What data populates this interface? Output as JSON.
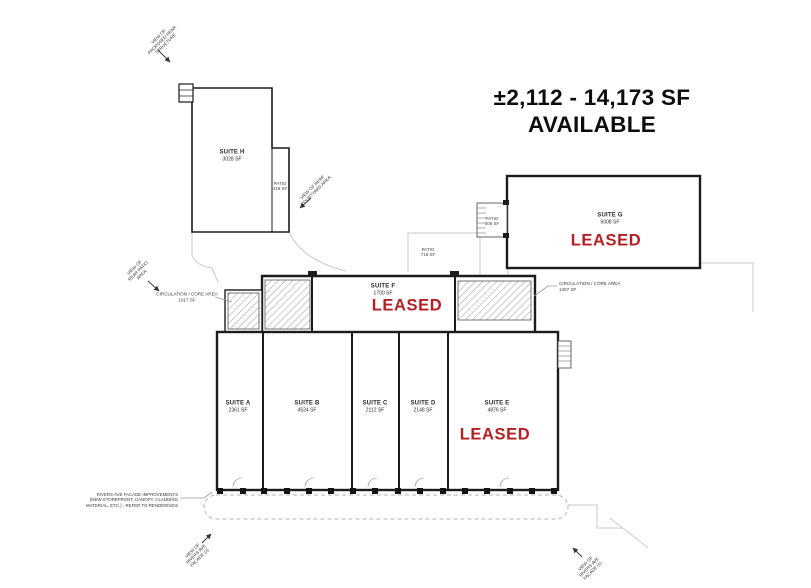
{
  "headline": {
    "line1": "±2,112 - 14,173 SF",
    "line2": "AVAILABLE"
  },
  "colors": {
    "leased_red": "#B41F24",
    "wall_dark": "#1c1c1c",
    "site_light": "#c9c9c9"
  },
  "suites": {
    "h": {
      "name": "SUITE H",
      "area": "3028 SF"
    },
    "g": {
      "name": "SUITE G",
      "area": "5008 SF",
      "status": "LEASED"
    },
    "f": {
      "name": "SUITE F",
      "area": "1700 SF",
      "status": "LEASED"
    },
    "a": {
      "name": "SUITE A",
      "area": "2361 SF"
    },
    "b": {
      "name": "SUITE B",
      "area": "4524 SF"
    },
    "c": {
      "name": "SUITE C",
      "area": "2112 SF"
    },
    "d": {
      "name": "SUITE D",
      "area": "2148 SF"
    },
    "e": {
      "name": "SUITE E",
      "area": "4876 SF",
      "status": "LEASED"
    }
  },
  "patios": {
    "h": {
      "label": "PATIO",
      "area": "418 SF"
    },
    "g": {
      "label": "PATIO",
      "area": "406 SF"
    },
    "center": {
      "label": "PATIO",
      "area": "718 SF"
    }
  },
  "circulation": {
    "left": {
      "line1": "CIRCULATION / CORE AREA",
      "line2": "1017 SF"
    },
    "right": {
      "line1": "CIRCULATION / CORE AREA",
      "line2": "1367 SF"
    }
  },
  "notes": {
    "rivers_line1": "RIVERS AVE FACADE IMPROVEMENTS",
    "rivers_line2": "(NEW STOREFRONT, CANOPY, CLADDING",
    "rivers_line3": "MATERIAL, ETC.) - REFER TO RENDERINGS"
  },
  "view_callouts": {
    "top_left": {
      "line1": "VIEW OF",
      "line2": "PROPOSED REAR",
      "line3": "STRUCTURE"
    },
    "courtyard": {
      "line1": "VIEW OF REAR",
      "line2": "COURTYARD AREA"
    },
    "left_mid": {
      "line1": "VIEW OF",
      "line2": "REAR PATIO",
      "line3": "AREA"
    },
    "bottom_left": {
      "line1": "VIEW OF",
      "line2": "RIVERS AVE",
      "line3": "FACADE (2)"
    },
    "bottom_right": {
      "line1": "VIEW OF",
      "line2": "RIVERS AVE",
      "line3": "FACADE (1)"
    }
  }
}
